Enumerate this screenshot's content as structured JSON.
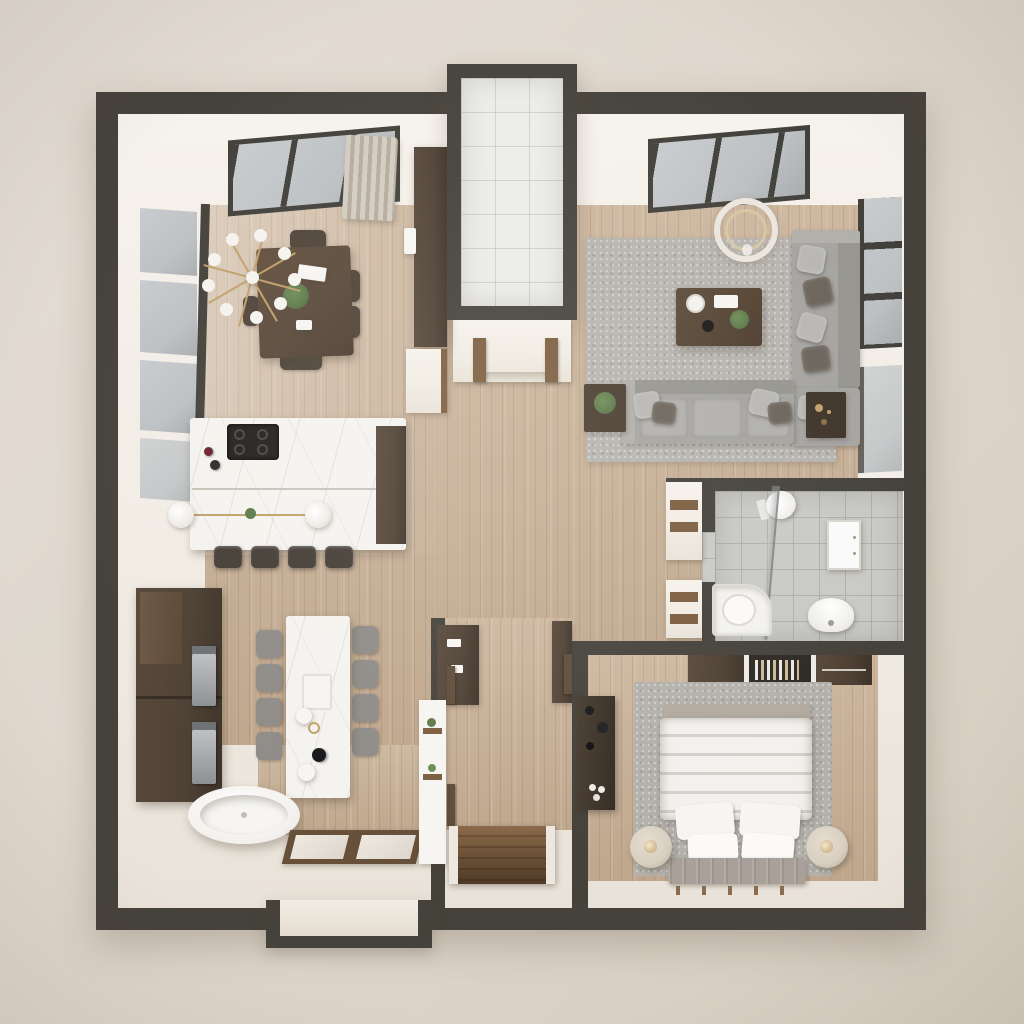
{
  "scene": {
    "title": "apartment-floor-plan-3d-render",
    "style": "top-down 3D architectural visualization, one-bedroom apartment",
    "visible_text": [],
    "palette": {
      "background": "#e4ddd4",
      "wall": "#45423b",
      "interior_white": "#f1ece4",
      "wood_floor": "#c6af96",
      "tile_white": "#ececea",
      "tile_gray": "#c9c9c6",
      "marble": "#f5f3ef",
      "dark_wood": "#4e4134",
      "walnut": "#5a4a3c",
      "rug_gray": "#b7b4af",
      "sofa_gray": "#a5a4a1",
      "pillow_light": "#b8b7b4",
      "pillow_dark": "#6b645b",
      "glass": "#bcc0c3",
      "steel": "#b9bcbe",
      "brass": "#c2a06a",
      "plant_green": "#5d7a4a",
      "fixture_white": "#f7f5f2",
      "nightstand_cream": "#d8cfc1",
      "bench_taupe": "#a9a199"
    },
    "rooms": [
      {
        "name": "dining-area",
        "position": "top-left",
        "furniture": [
          "walnut-dining-table",
          "dining-chairs",
          "sputnik-chandelier",
          "table-plant",
          "books",
          "clerestory-skylight",
          "curtain",
          "side-windows"
        ]
      },
      {
        "name": "kitchen",
        "position": "mid-left",
        "furniture": [
          "marble-island",
          "gas-cooktop",
          "wine-bottles",
          "pendant-globes",
          "bar-stools",
          "tall-cabinets",
          "double-wall-ovens"
        ]
      },
      {
        "name": "living-room",
        "position": "top-right",
        "furniture": [
          "sectional-sofa",
          "throw-pillows",
          "coffee-table",
          "decor-tray",
          "plant",
          "area-rug",
          "ring-chandelier",
          "side-table",
          "accent-table",
          "skylight",
          "wall-window"
        ]
      },
      {
        "name": "entry-vestibule",
        "position": "top-center",
        "furniture": [
          "tiled-floor",
          "entry-portal",
          "door-posts",
          "coat-closet",
          "wall-panel"
        ]
      },
      {
        "name": "bathroom",
        "position": "mid-right",
        "furniture": [
          "toilet",
          "glass-shower-screen",
          "shower-tray",
          "sink",
          "wall-cabinet",
          "niche-shelves",
          "gray-tile-floor"
        ]
      },
      {
        "name": "bedroom",
        "position": "bottom-right",
        "furniture": [
          "double-bed",
          "duvet",
          "pillows",
          "foot-bench",
          "nightstands",
          "table-lamps",
          "area-rug",
          "wardrobe-row",
          "book-shelf",
          "decor-shelf"
        ]
      },
      {
        "name": "hallway-stairs",
        "position": "bottom-center",
        "furniture": [
          "staircase-down",
          "door-leaves",
          "console-cabinet",
          "shelf-panel",
          "mini-plants"
        ]
      },
      {
        "name": "dining-nook-bath-corner",
        "position": "bottom-left",
        "furniture": [
          "marble-long-table",
          "fabric-chairs",
          "tableware",
          "freestanding-bathtub",
          "glass-floor-panels",
          "exterior-bay"
        ]
      }
    ],
    "counts": {
      "bar_stools": 4,
      "long_table_chairs": 8,
      "bed_pillows": 4,
      "nightstands": 2,
      "skylights": 2,
      "pendant_globes": 2
    }
  }
}
